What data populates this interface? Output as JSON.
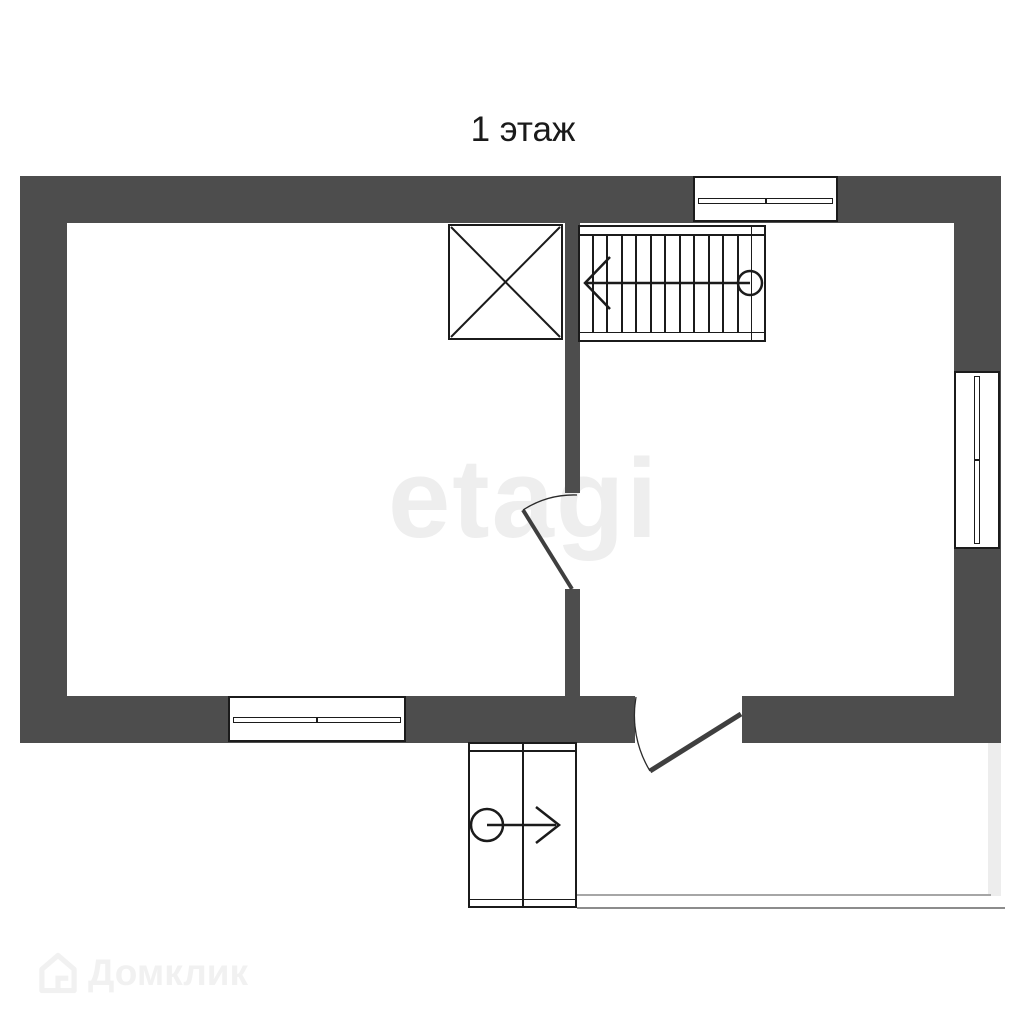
{
  "title": "1 этаж",
  "watermark_center": "etagi",
  "watermark_domclick": "Домклик",
  "colors": {
    "wall": "#4d4d4d",
    "line": "#1b1b1b",
    "watermark_light": "#eeeeee",
    "terrace_line_light": "#a6a6a6",
    "terrace_line_dark": "#8c8c8c"
  },
  "stairs": {
    "treads": 11,
    "direction_arrow": "left",
    "start_marker": "circle"
  },
  "symbols": {
    "shaft": "crossed-square",
    "entrance": "circle-arrow-right",
    "windows": 3,
    "interior_doors": 1,
    "exterior_doors": 1
  }
}
